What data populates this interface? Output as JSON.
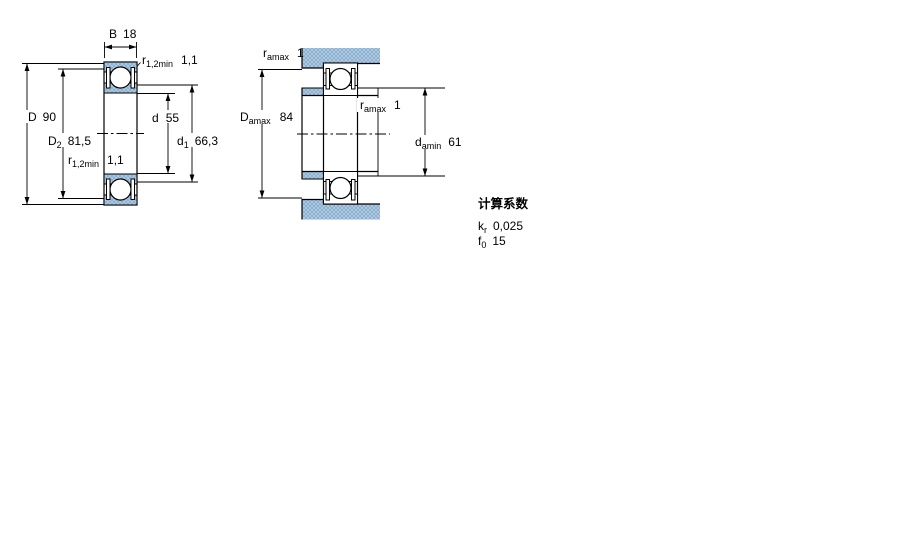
{
  "background": "#ffffff",
  "line_color": "#000000",
  "hatch": {
    "fill": "#b4cfe6",
    "line": "#87abcc"
  },
  "left_view": {
    "B": {
      "main": "B",
      "value": "18"
    },
    "r12min_top": {
      "main": "r",
      "sub": "1,2min",
      "value": "1,1"
    },
    "D": {
      "main": "D",
      "value": "90"
    },
    "D2": {
      "main": "D",
      "sub": "2",
      "value": "81,5"
    },
    "d": {
      "main": "d",
      "value": "55"
    },
    "d1": {
      "main": "d",
      "sub": "1",
      "value": "66,3"
    },
    "r12min_bottom": {
      "main": "r",
      "sub": "1,2min",
      "value": "1,1"
    }
  },
  "right_view": {
    "ramax_top": {
      "main": "r",
      "sub": "amax",
      "value": "1"
    },
    "Damax": {
      "main": "D",
      "sub": "amax",
      "value": "84"
    },
    "ramax_mid": {
      "main": "r",
      "sub": "amax",
      "value": "1"
    },
    "damin": {
      "main": "d",
      "sub": "amin",
      "value": "61"
    }
  },
  "calculation_factors": {
    "title": "计算系数",
    "kr": {
      "main": "k",
      "sub": "r",
      "value": "0,025"
    },
    "f0": {
      "main": "f",
      "sub": "0",
      "value": "15"
    }
  }
}
